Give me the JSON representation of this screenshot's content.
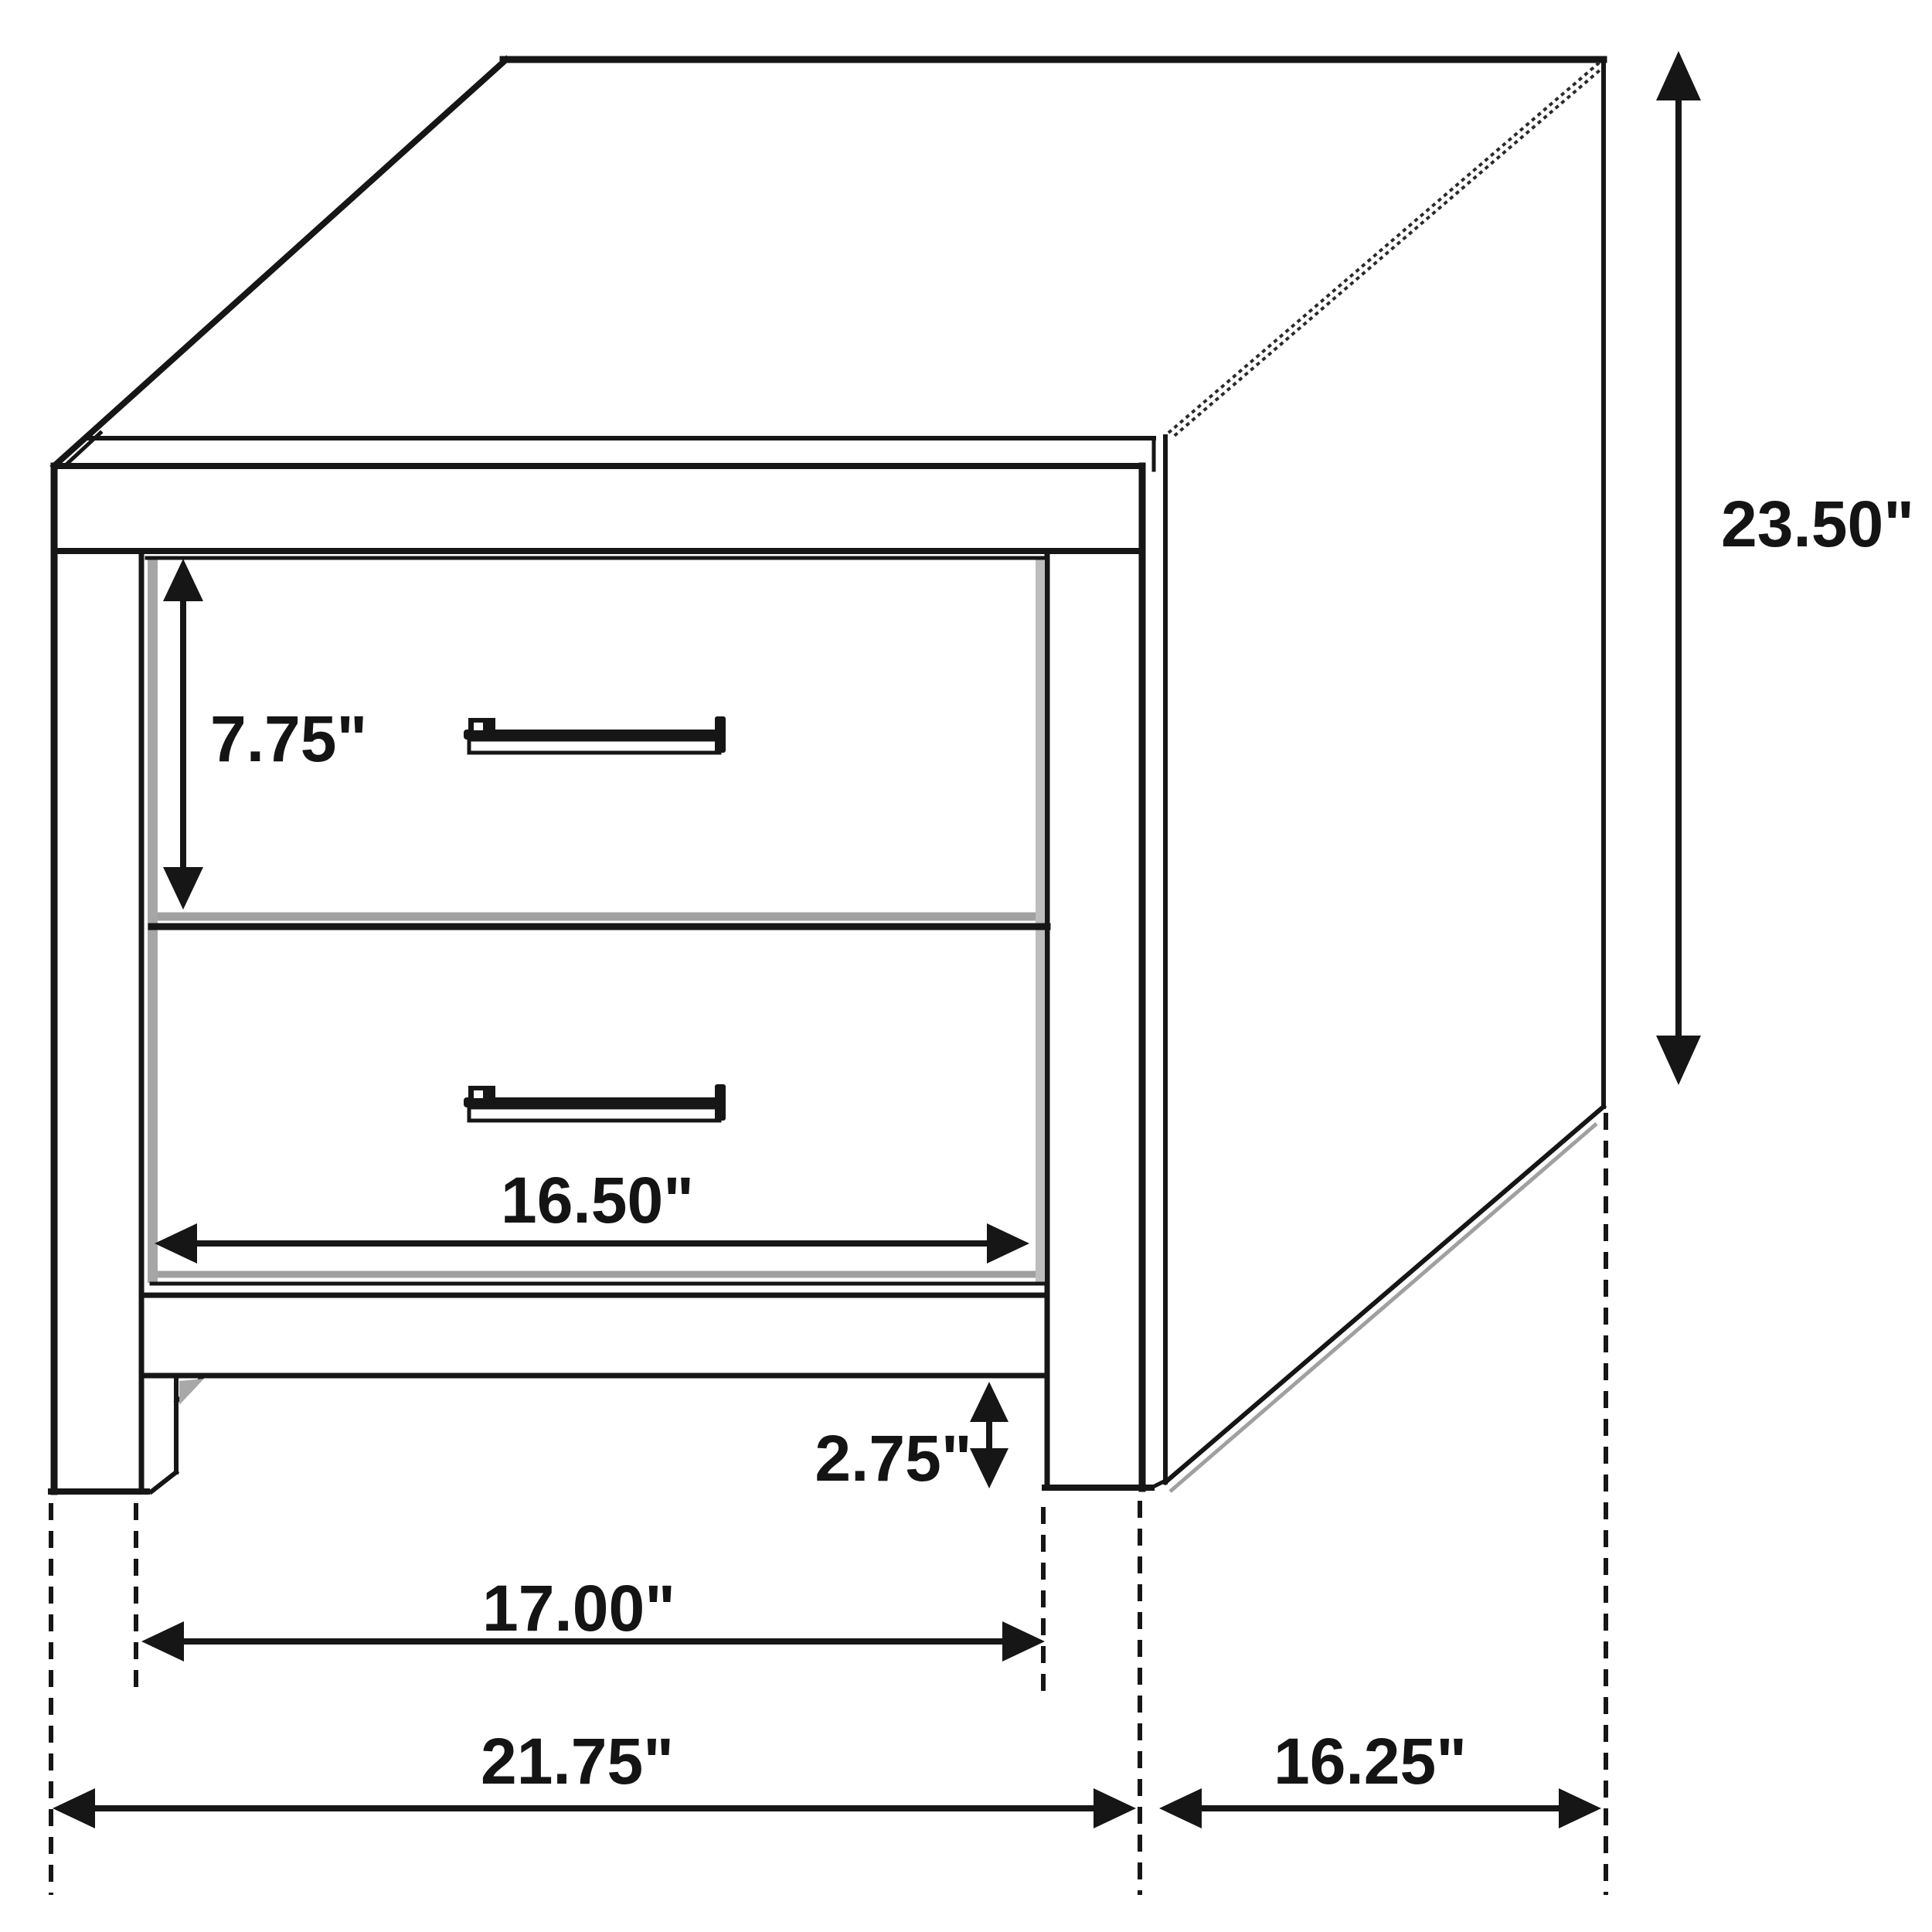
{
  "diagram": {
    "subject": "two-drawer-nightstand-dimension-diagram",
    "background_color": "#ffffff",
    "line_color": "#161616",
    "shadow_color": "#a0a0a0",
    "units": "inches",
    "labels": {
      "drawer_height": "7.75\"",
      "overall_height": "23.50\"",
      "drawer_width": "16.50\"",
      "leg_height": "2.75\"",
      "inner_width": "17.00\"",
      "overall_width": "21.75\"",
      "depth": "16.25\""
    }
  }
}
